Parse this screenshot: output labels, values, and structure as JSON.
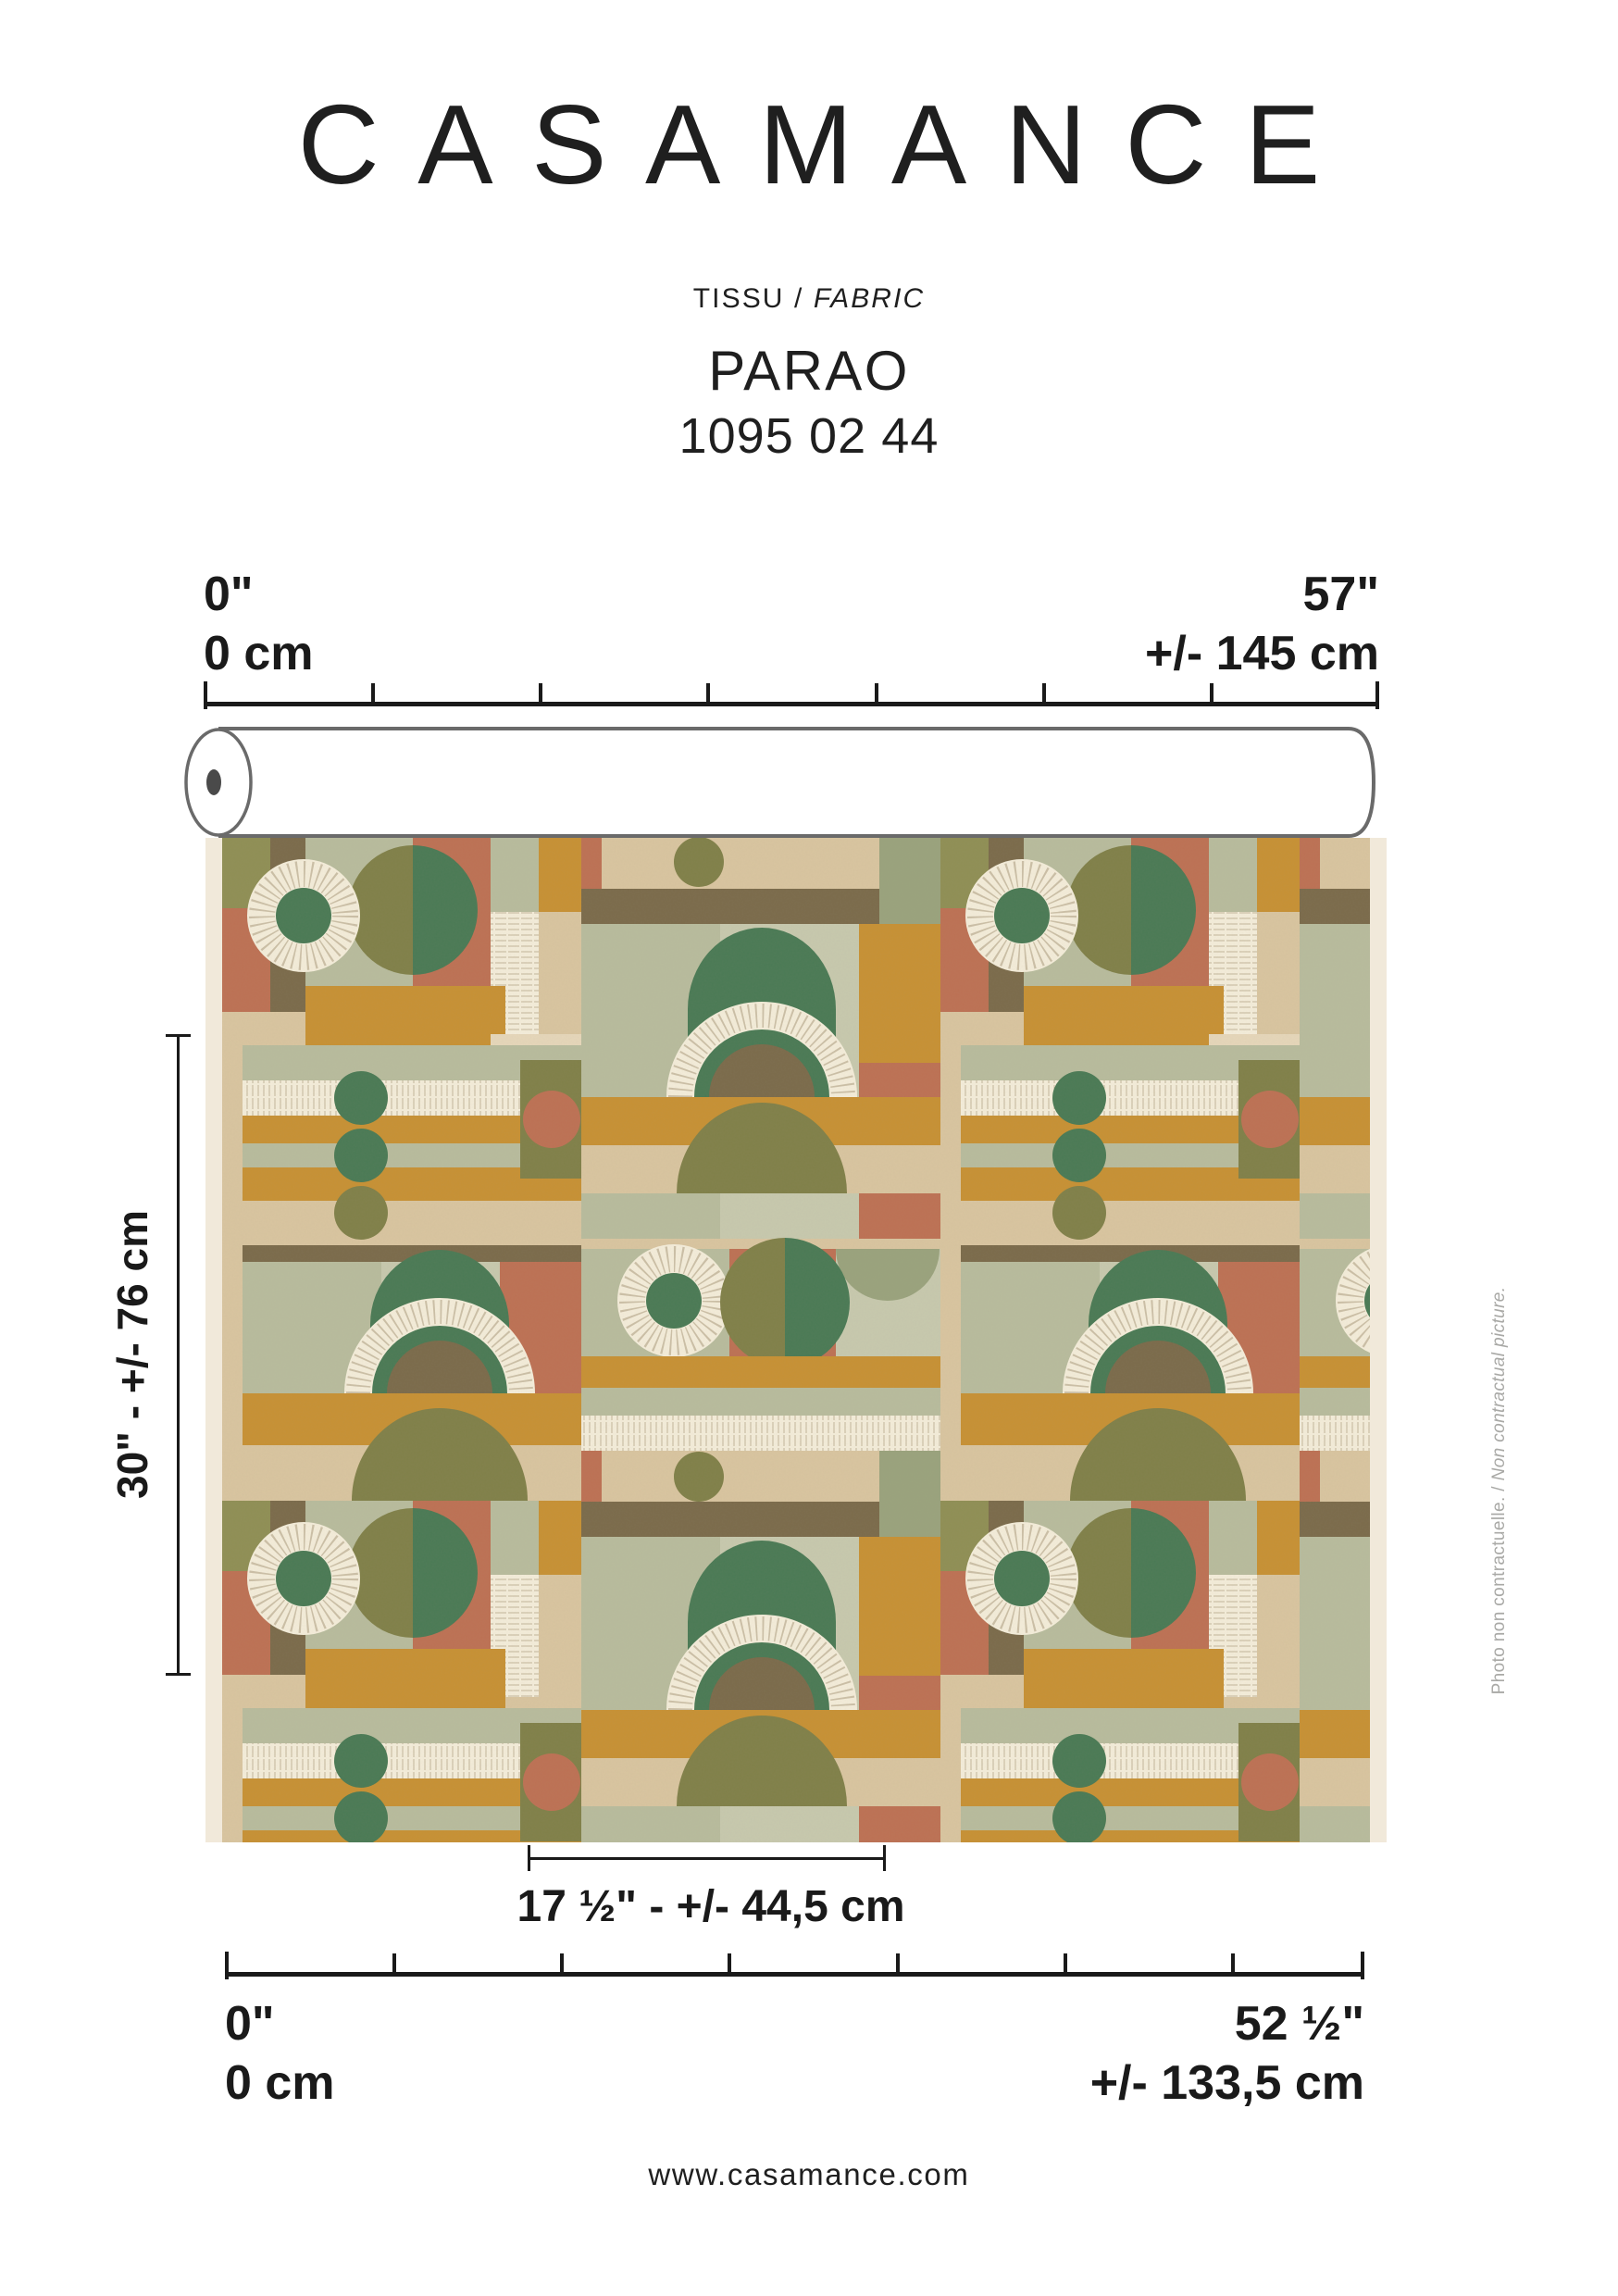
{
  "page": {
    "background": "#ffffff"
  },
  "brand": {
    "logo_text": "CASAMANCE"
  },
  "product": {
    "category_fr": "TISSU",
    "separator": " / ",
    "category_en": "FABRIC",
    "name": "PARAO",
    "reference": "1095 02 44"
  },
  "dimensions": {
    "top_scale": {
      "left_inches": "0\"",
      "left_cm": "0 cm",
      "right_inches": "57\"",
      "right_cm": "+/- 145 cm"
    },
    "bottom_scale": {
      "left_inches": "0\"",
      "left_cm": "0 cm",
      "right_inches": "52 ½\"",
      "right_cm": "+/- 133,5 cm"
    },
    "vertical_repeat": {
      "label": "30\" - +/- 76 cm"
    },
    "horizontal_repeat": {
      "label": "17 ½\" - +/- 44,5 cm"
    }
  },
  "disclaimer": {
    "text_fr": "Photo non contractuelle.",
    "separator": " / ",
    "text_en": "Non contractual picture."
  },
  "footer": {
    "website": "www.casamance.com"
  },
  "palette": {
    "sage": "#b8bc9d",
    "sage_light": "#c7c9ae",
    "sage_dark": "#9aa37d",
    "dark_green": "#4a7a55",
    "olive": "#808049",
    "olive_bright": "#8f8f55",
    "terracotta": "#bd7154",
    "ochre": "#c79134",
    "beige": "#d9c5a0",
    "beige_light": "#e6d7ba",
    "cream": "#f4edda",
    "brown": "#7b6b4b",
    "selvage": "#f1e9da",
    "ink": "#1a1a1a",
    "caption_gray": "#a9a9a6"
  }
}
